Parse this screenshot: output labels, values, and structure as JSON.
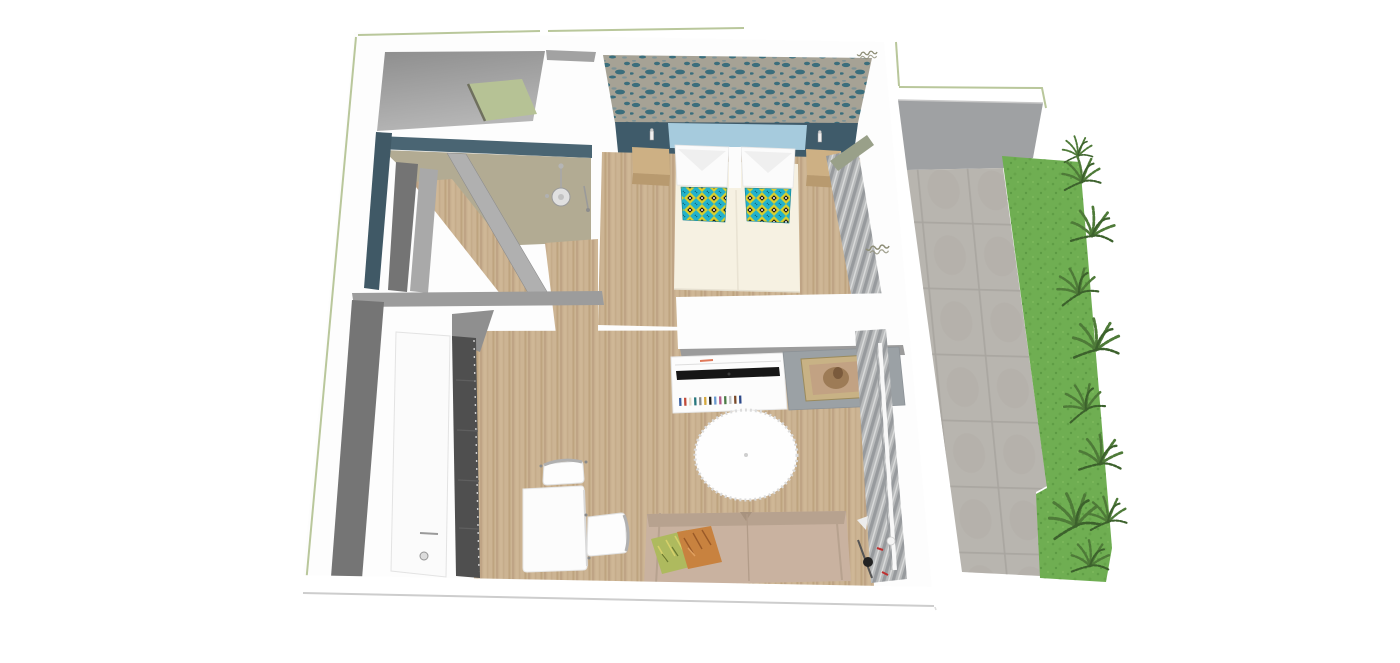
{
  "scene": {
    "type": "3d-floorplan-top-view-render",
    "description": "Bird's-eye 3D render of a studio apartment with bathroom, twin-bed bedroom, living-dining area and a paved terrace with garden strip"
  },
  "palette": {
    "background": "#ffffff",
    "wall_white": "#fdfdfd",
    "wall_gray_dark": "#757575",
    "wall_gray_mid": "#9c9c9c",
    "terrace_wall": "#9fa1a3",
    "outline_green": "#b9c79b",
    "teal_wall": "#3f5b6a",
    "teal_band": "#4a6573",
    "teal_sliver": "#405966",
    "light_blue_strip": "#a6cbdd",
    "sage_panel": "#b6c295",
    "tile_beige": "#b2ab93",
    "wood_base": "#ccb493",
    "wood_stripe": "#b99f7c",
    "cream_bedding": "#f6f1e2",
    "pillow_white": "#fbfbfb",
    "cushion_teal": "#23b2cb",
    "cushion_yellow": "#d8ce2e",
    "wallpaper_base": "#a6a295",
    "wallpaper_teal": "#2f6879",
    "curtain_gray": "#b8babb",
    "curtain_stripe": "#979a9d",
    "tv_black": "#161616",
    "console_white": "#fcfcfc",
    "cabinet_gray": "#9ba1a5",
    "frame_gold": "#c8b285",
    "art_skin": "#c2a283",
    "rug_white": "#fefefe",
    "sofa_tan": "#c9b2a0",
    "sofa_back": "#b7a28f",
    "pillow_green": "#aeba5e",
    "pillow_orange": "#c8823f",
    "table_white": "#fcfcfc",
    "door_white": "#fbfbfb",
    "wardrobe_dark": "#4f4f4f",
    "paving_gray": "#b8b5af",
    "paving_line": "#a9a6a0",
    "grass_green": "#6fae52",
    "fern_green": "#4e7a38",
    "note_ink": "#8f8f78"
  },
  "annotations": [
    {
      "id": "wall-note-top-right",
      "legible": false
    },
    {
      "id": "wall-note-right-mid",
      "legible": false
    }
  ],
  "inventory": [
    "shower-head",
    "twin-bed-left",
    "twin-bed-right",
    "nightstand-left",
    "nightstand-right",
    "wall-sconce-left",
    "wall-sconce-right",
    "sheer-curtain-bedroom",
    "sheer-curtain-living",
    "tv-console",
    "television",
    "book-row",
    "framed-artwork",
    "round-rug",
    "sofa",
    "sofa-cushion-green",
    "sofa-cushion-orange",
    "dining-table",
    "chair-top",
    "chair-right",
    "entry-door",
    "wardrobe",
    "terrace-paving",
    "garden-grass",
    "fern-plants"
  ]
}
